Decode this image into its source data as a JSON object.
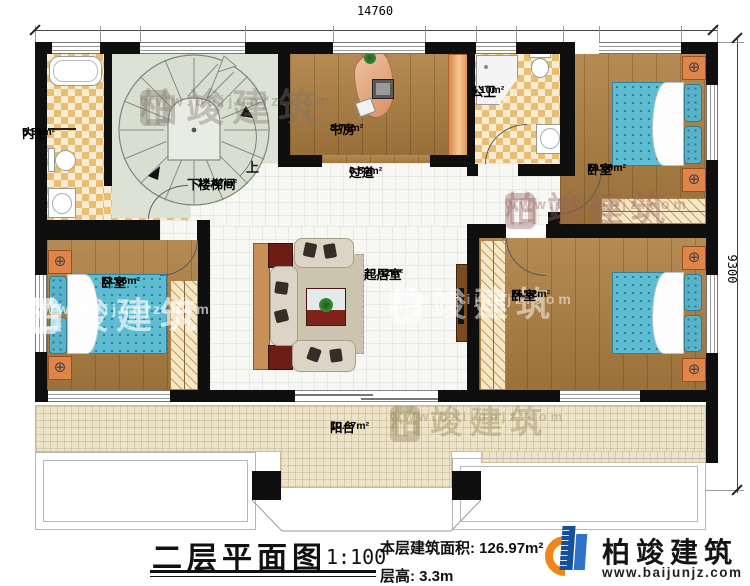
{
  "dimensions": {
    "top": "14760",
    "right": "9300"
  },
  "rooms": [
    {
      "name": "内卫",
      "area": "5.55m²"
    },
    {
      "name": "楼梯间",
      "area": "12.67m²"
    },
    {
      "name": "书房",
      "area": "8.74m²"
    },
    {
      "name": "公卫",
      "area": "4.10m²"
    },
    {
      "name": "卧室",
      "area": "10.89m²"
    },
    {
      "name": "过道",
      "area": "6.80m²"
    },
    {
      "name": "起居室",
      "area": "20.42m²"
    },
    {
      "name": "卧室",
      "area": "12.66m²"
    },
    {
      "name": "卧室",
      "area": "16.82m²"
    },
    {
      "name": "阳台",
      "area": "10.87m²"
    }
  ],
  "stairs": {
    "up": "上",
    "down": "下"
  },
  "title": {
    "name": "二层平面图",
    "scale": "1:100",
    "area_label": "本层建筑面积:",
    "area_value": "126.97m²",
    "height_label": "层高:",
    "height_value": "3.3m"
  },
  "brand": {
    "name": "柏竣建筑",
    "url": "www.baijunjz.com"
  },
  "colors": {
    "wall": "#0f0f0f",
    "wood_floor": "#ad7e40",
    "tile_checker": "#e9bd72",
    "stair_floor": "#dce2d6",
    "balcony_floor": "#ece3c8",
    "bed_blue": "#5fbdd3",
    "nightstand_orange": "#e0854a",
    "brand_blue": "#164f9a",
    "brand_orange": "#f08519"
  }
}
